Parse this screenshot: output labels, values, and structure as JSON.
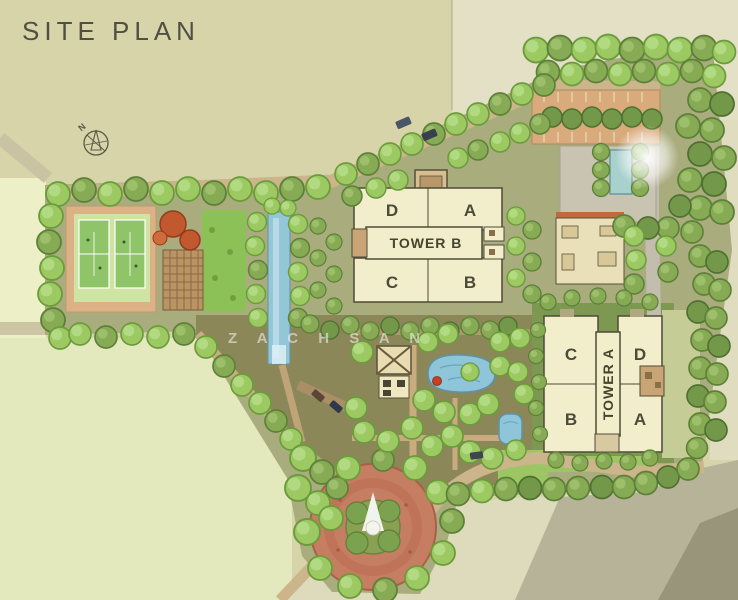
{
  "title": "SITE PLAN",
  "compass": {
    "label": "N"
  },
  "watermark": {
    "text": "Z A C H S A N"
  },
  "towers": {
    "tower_b": {
      "label": "TOWER B",
      "wing_top_left": "D",
      "wing_top_right": "A",
      "wing_bottom_left": "C",
      "wing_bottom_right": "B"
    },
    "tower_a": {
      "label": "TOWER A",
      "wing_top_left": "C",
      "wing_top_right": "D",
      "wing_bottom_left": "B",
      "wing_bottom_right": "A"
    }
  },
  "palette": {
    "background_khaki": "#d8d4a9",
    "background_pale_green": "#e3e8bd",
    "tree_green": "#9cc962",
    "olive_green": "#86ab54",
    "water_blue": "#8ec5d8",
    "plaza_terracotta": "#c67e62",
    "building_cream": "#f2edca",
    "road_tan": "#ccb48b",
    "court_green": "#8fc568",
    "accent_red": "#c2582e"
  }
}
